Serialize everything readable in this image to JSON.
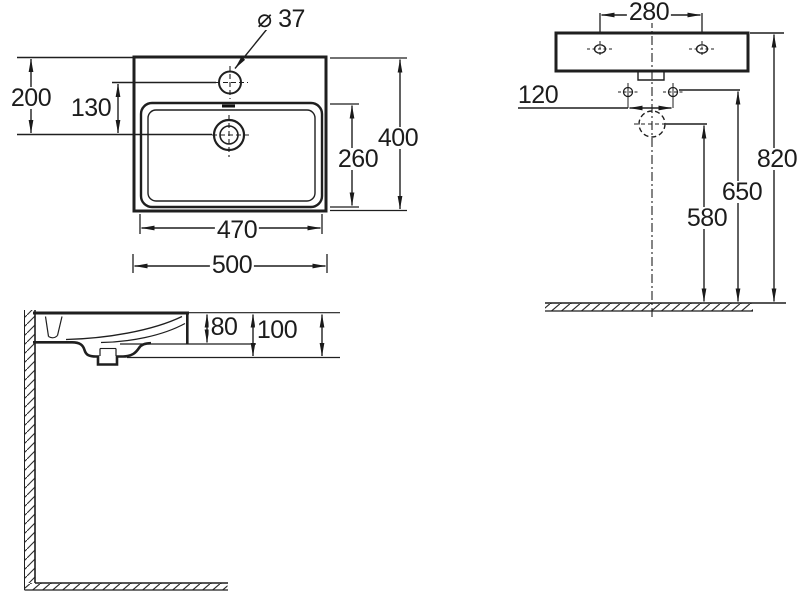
{
  "drawing": {
    "plan_view": {
      "faucet_hole_diameter": "⌀ 37",
      "rim_to_drain": "200",
      "faucet_to_drain": "130",
      "bowl_depth": "260",
      "overall_depth": "400",
      "bowl_width": "470",
      "overall_width": "500"
    },
    "front_view": {
      "fixing_hole_spacing": "280",
      "fixture_spacing": "120",
      "rim_height": "820",
      "fixing_bolt_height": "650",
      "drain_height": "580"
    },
    "side_view": {
      "rim_to_bowl_bottom": "80",
      "rim_to_underside": "100"
    }
  }
}
